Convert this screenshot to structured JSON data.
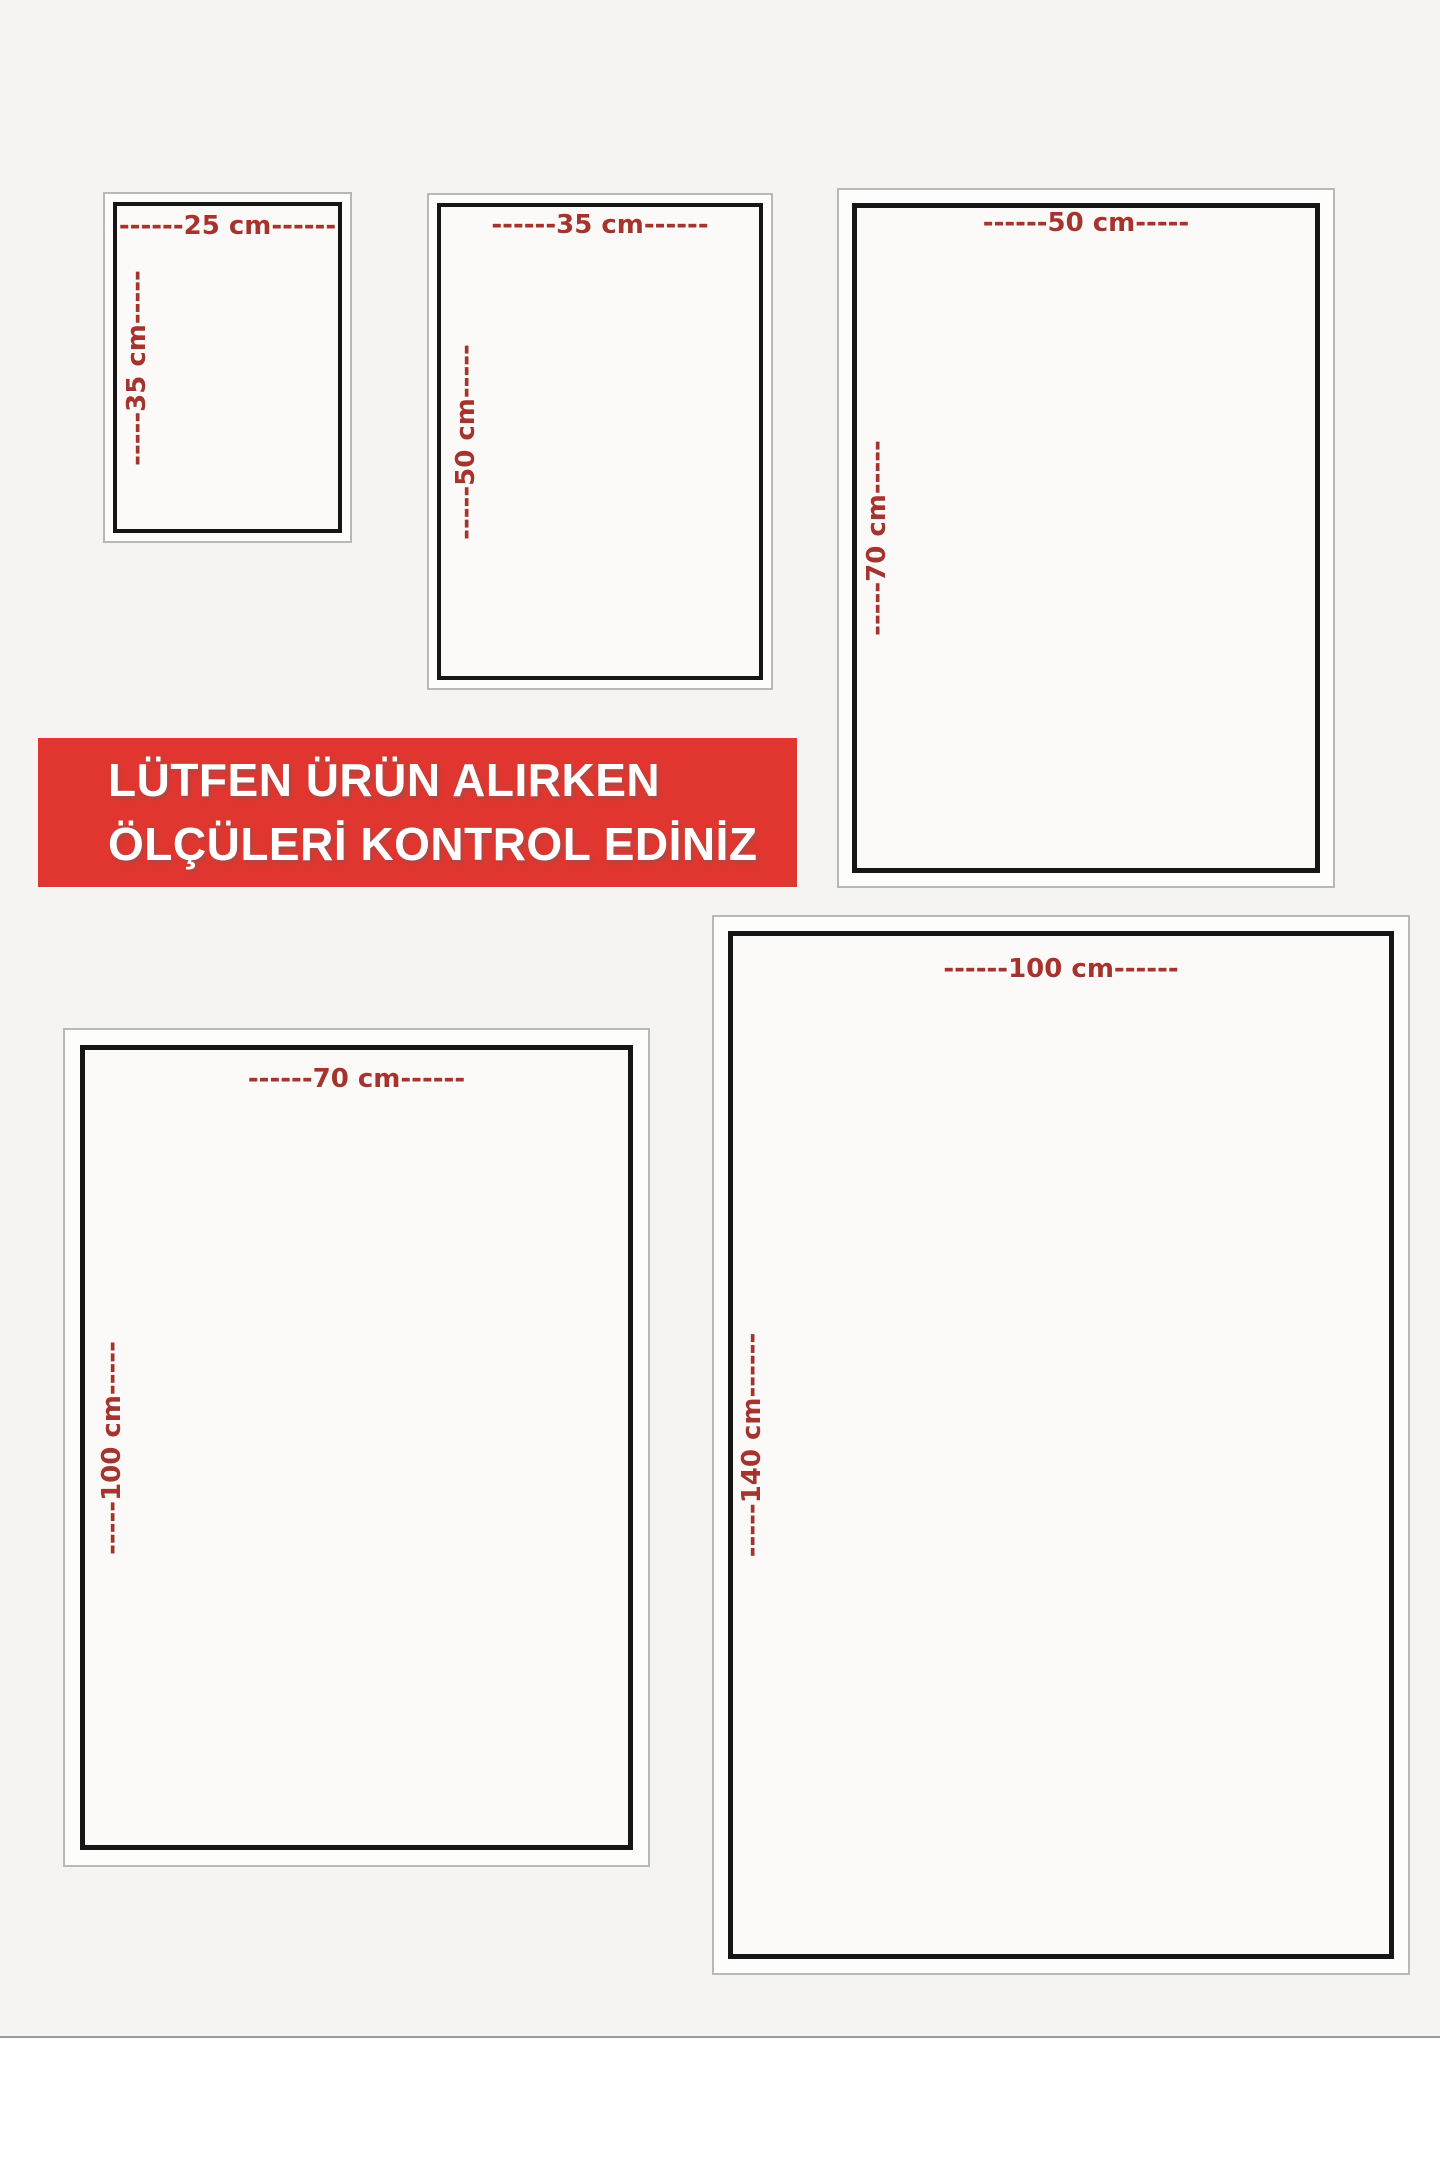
{
  "banner": {
    "line1": "LÜTFEN ÜRÜN ALIRKEN",
    "line2": "ÖLÇÜLERİ KONTROL EDİNİZ"
  },
  "sizes": [
    {
      "name": "25x35",
      "width_cm": 25,
      "height_cm": 35,
      "width_label": "------25 cm------",
      "height_label": "-----35 cm-----"
    },
    {
      "name": "35x50",
      "width_cm": 35,
      "height_cm": 50,
      "width_label": "------35 cm------",
      "height_label": "-----50 cm-----"
    },
    {
      "name": "50x70",
      "width_cm": 50,
      "height_cm": 70,
      "width_label": "------50 cm-----",
      "height_label": "-----70 cm-----"
    },
    {
      "name": "70x100",
      "width_cm": 70,
      "height_cm": 100,
      "width_label": "------70 cm------",
      "height_label": "-----100 cm-----"
    },
    {
      "name": "100x140",
      "width_cm": 100,
      "height_cm": 140,
      "width_label": "------100 cm------",
      "height_label": "-----140 cm------"
    }
  ],
  "colors": {
    "background": "#f5f4f1",
    "banner_red": "#e0362f",
    "label_red": "#a6342e",
    "frame_black": "#161616",
    "frame_gray": "#b8b8b6"
  }
}
